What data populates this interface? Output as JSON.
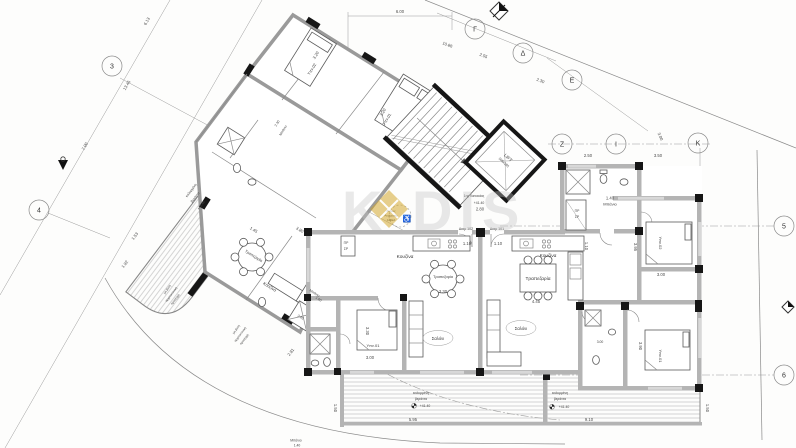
{
  "colors": {
    "accent_gold": "#D2A427",
    "wall_gray": "#b4b4b4",
    "wall_black": "#161616",
    "line_gray": "#8a8a8a"
  },
  "watermark": {
    "left": "K",
    "right": "DIS"
  },
  "grid": {
    "b3": "3",
    "b4": "4",
    "g": "Γ",
    "d": "Δ",
    "e": "Ε",
    "z": "Ζ",
    "i": "Ι",
    "k": "Κ",
    "b5": "5",
    "b6": "6"
  },
  "site_dims": {
    "top": "6.00",
    "t1": "10.86",
    "t2": "2.55",
    "t3": "2.30",
    "t4": "3.00",
    "l1": "6.13",
    "l2": "13.45",
    "l3": "7.00",
    "l4": "1.53",
    "l5": "1.92",
    "l6": "2.81"
  },
  "note": {
    "l1": "μη βατή",
    "l2": "αρχιτεκτονική",
    "l3": "προεξοχή"
  },
  "core": {
    "lift": "LIFT",
    "lift_size": "105x185",
    "level_label": "1ης Κατοικίας",
    "level": "+41.40",
    "dim": "2.80",
    "amea1": "Χώρος",
    "amea2": "Αναμονής",
    "amea3": "ΑΜΕΑ",
    "wheelchair": "♿"
  },
  "apt102": {
    "name": "Διαμ 102",
    "door_dim": "1.10",
    "kitchen": "Κουζίνα",
    "pr": "ΠΡ",
    "sr": "ΣΡ",
    "dining": "Τραπεζαρία",
    "dining_dim": "3.30",
    "living": "Σαλόνι",
    "bed": "Υπν.01",
    "bed_w": "3.30",
    "bed_l": "3.00",
    "bath": "Μπάνιο",
    "bath_dim": "1.40"
  },
  "apt101": {
    "name": "Διαμ 101",
    "door_dim": "1.10",
    "door2_dim": "1.10",
    "kitchen": "Κουζίνα",
    "dining": "Τραπεζαρία",
    "dining_dim": "4.45",
    "living": "Σαλόνι",
    "pr": "ΠΡ",
    "sr": "ΣΡ",
    "bath": "Μπάνιο",
    "bath_dim": "1.40",
    "bed2": "Υπν.02",
    "bed2_w": "3.95",
    "bed2_l": "3.00",
    "bed1": "Υπν.01",
    "bed1_w": "3.90",
    "bath2_dim": "3.00",
    "top_d1": "2.50",
    "top_d2": "3.50"
  },
  "wing": {
    "bed1": "Υπν.01",
    "bed2": "Υπν.02",
    "bath": "Μπάνιο",
    "bath_dim": "2.30",
    "bath2": "Μπάνιο",
    "bath2_dim": "1.60",
    "shower_dim": "3.45",
    "kitchen": "Κουζίνα",
    "dining": "Τραπεζαρία",
    "d1": "3.20",
    "d2": "3.20",
    "d3": "3.80",
    "d4": "1.45"
  },
  "veranda": {
    "l1": "καλυμμένη",
    "l2": "βεράντα",
    "level": "+41.40",
    "left_dim": "5.95",
    "right_dim": "9.10",
    "depth": "1.50"
  }
}
